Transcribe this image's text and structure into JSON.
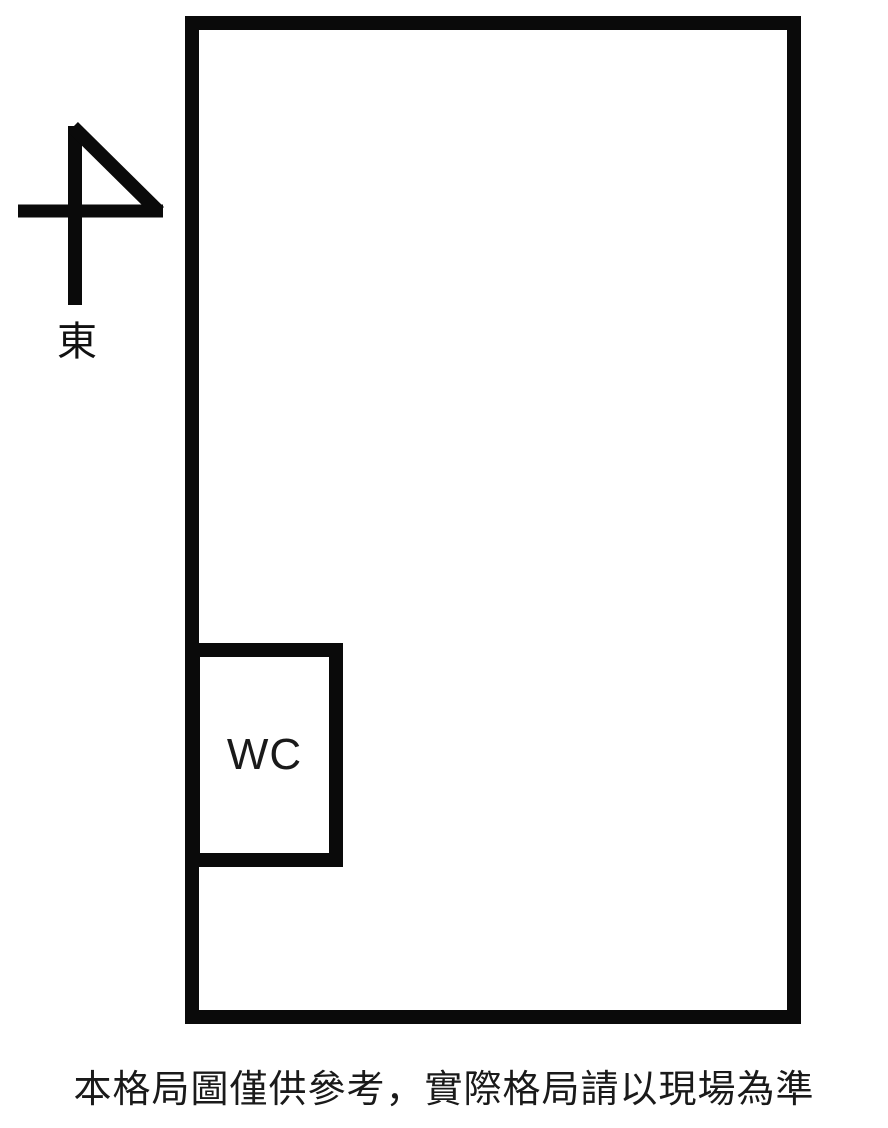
{
  "compass": {
    "direction_label": "東"
  },
  "rooms": {
    "wc": {
      "label": "WC"
    }
  },
  "caption": {
    "text": "本格局圖僅供參考，實際格局請以現場為準"
  },
  "colors": {
    "wall": "#0a0a0a",
    "background": "#ffffff",
    "text": "#1a1a1a"
  }
}
